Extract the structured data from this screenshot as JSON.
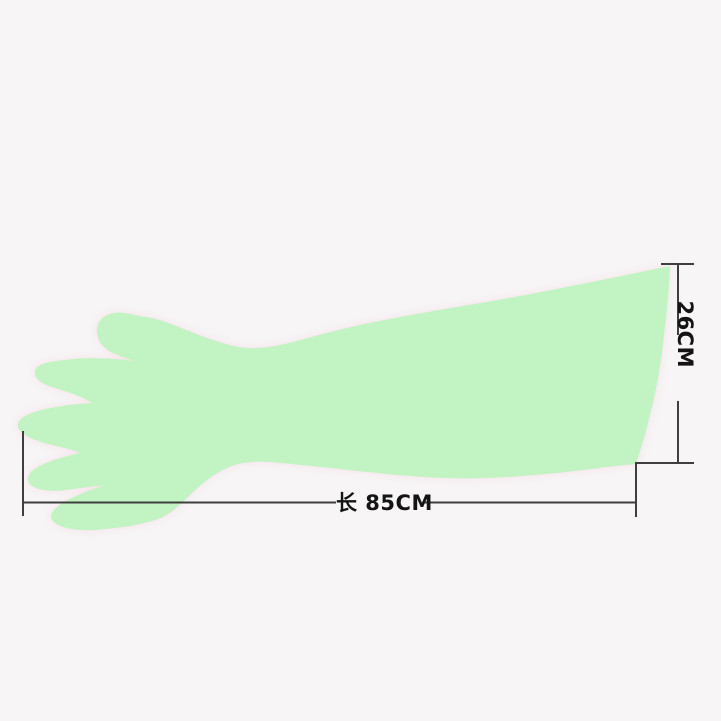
{
  "image": {
    "background_color": "#f7f5f6",
    "subject": "disposable long-sleeve veterinary glove, left hand, fingers pointing left, long cuff opening at right"
  },
  "glove": {
    "fill_color": "#c1f3c3",
    "halo_tint": "#f7dee6"
  },
  "annotations": {
    "line_color": "#3f3f3f",
    "text_color": "#141414",
    "length_dimension": {
      "label": "长 85CM",
      "orientation": "horizontal"
    },
    "width_dimension": {
      "label": "26CM",
      "orientation": "vertical-rotated-90"
    }
  }
}
